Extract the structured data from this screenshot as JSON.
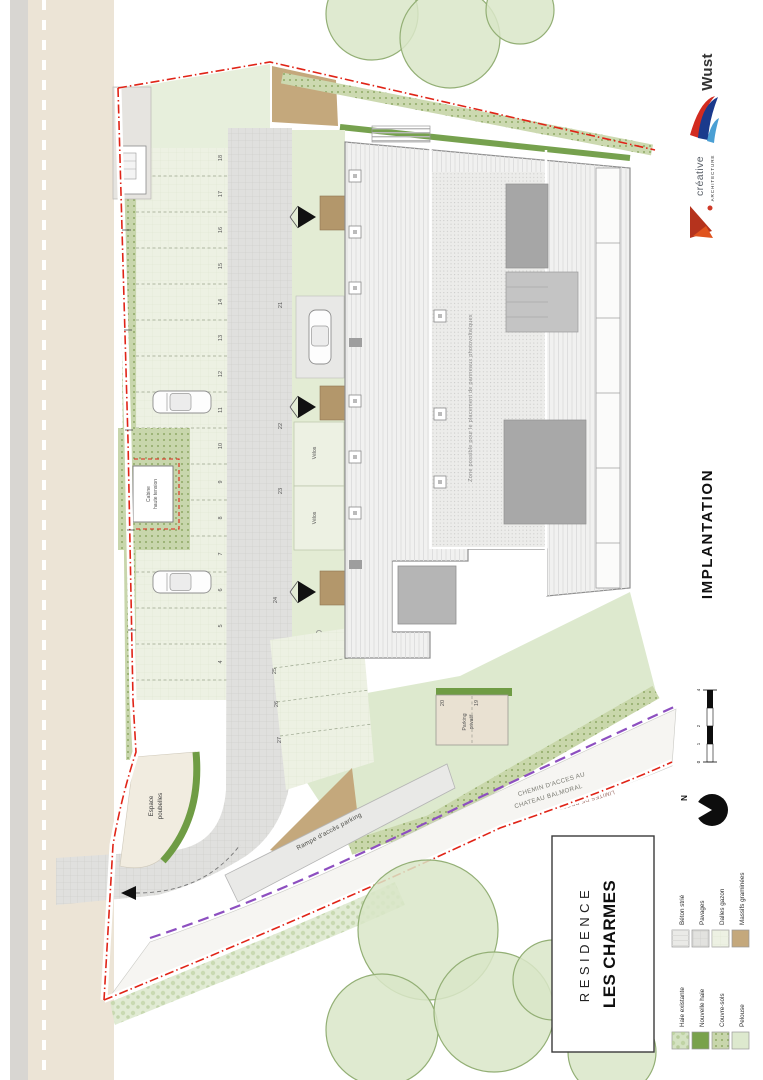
{
  "colors": {
    "boundary_red": "#e02417",
    "limit_purple": "#8d4fc0",
    "hedge_dark": "#6f9c44",
    "wust_blue": "#1b3a8c",
    "creative_red": "#cf3a28"
  },
  "title_block": {
    "project": "RESIDENCE",
    "name": "LES CHARMES"
  },
  "sheet_title": "IMPLANTATION",
  "logos": {
    "creative_name": "créative",
    "creative_sub": "ARCHITECTURE",
    "builder": "Wust"
  },
  "north": {
    "label": "N"
  },
  "scale": {
    "labels": [
      "0",
      "1",
      "2",
      "4"
    ]
  },
  "legend": {
    "materials": [
      {
        "label": "Béton strié",
        "color": "#eaeae7"
      },
      {
        "label": "Pavages",
        "color": "#e2e2df"
      },
      {
        "label": "Dalles gazon",
        "color": "#edf1e3"
      },
      {
        "label": "Massifs graminées",
        "color": "#c4a87c"
      }
    ],
    "greens": [
      {
        "label": "Haie existante",
        "color": "#d4e2c2"
      },
      {
        "label": "Nouvelle haie",
        "color": "#79a24b"
      },
      {
        "label": "Couvre-sols",
        "color": "#c8d6ac"
      },
      {
        "label": "Pelouse",
        "color": "#dde9ce"
      }
    ]
  },
  "labels": {
    "pv_zone": "Zone possible pour le placement de panneaux photovoltaïques",
    "ramp": "Rampe d'accès parking",
    "waste_1": "Espace",
    "waste_2": "poubelles",
    "cabin_1": "Cabine",
    "cabin_2": "haute tension",
    "private_1": "Parking",
    "private_2": "privatif",
    "road_1": "CHEMIN D'ACCES AU",
    "road_2": "CHATEAU BALMORAL",
    "property_limit": "LIMITES DE PROPRIETES",
    "velos_a": "Vélos",
    "velos_b": "Vélos"
  },
  "stalls": {
    "left": [
      "18",
      "17",
      "16",
      "15",
      "14",
      "13",
      "12",
      "11",
      "10",
      "9",
      "8",
      "7",
      "6",
      "5",
      "4"
    ],
    "mid": [
      "21",
      "22",
      "23"
    ],
    "bottom": [
      "24",
      "25",
      "26",
      "27"
    ],
    "private": [
      "20",
      "19"
    ]
  }
}
